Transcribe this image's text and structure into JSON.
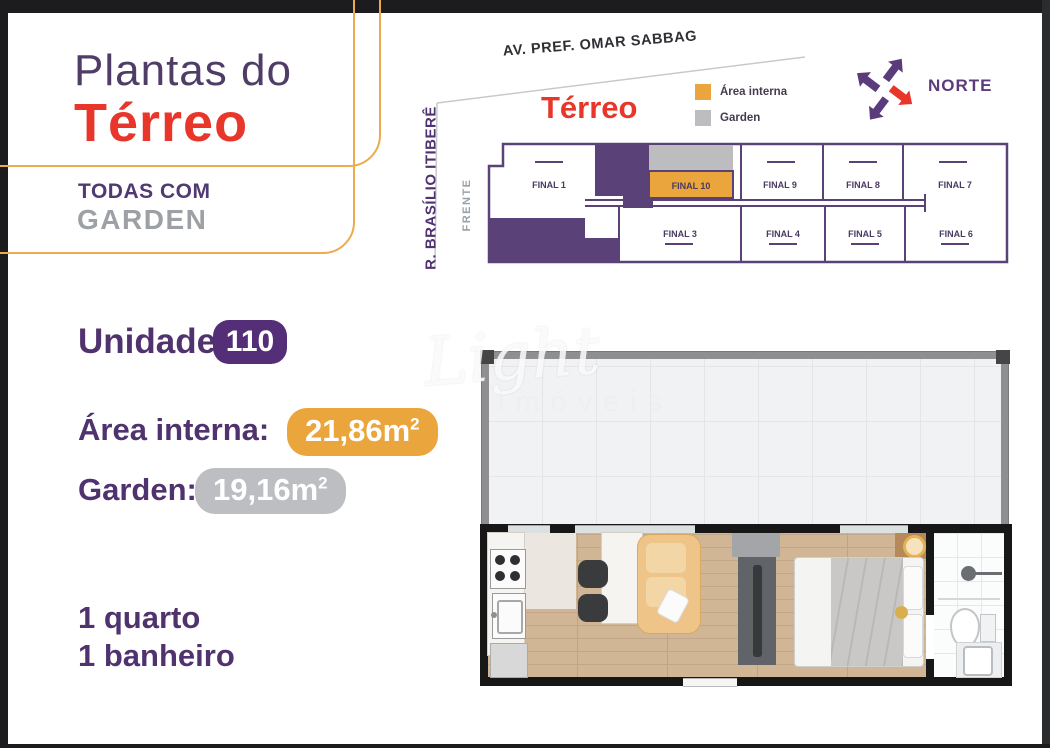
{
  "header_card": {
    "title_line1": "Plantas do",
    "title_line2": "Térreo",
    "subtitle_line1": "TODAS COM",
    "subtitle_line2": "GARDEN"
  },
  "site_plan": {
    "street_top": "AV. PREF. OMAR SABBAG",
    "street_left": "R. BRASÍLIO ITIBERÊ",
    "front_label": "FRENTE",
    "title": "Térreo",
    "legend": [
      {
        "label": "Área interna",
        "color": "#EAA63C"
      },
      {
        "label": "Garden",
        "color": "#BDBDBF"
      }
    ],
    "compass_label": "NORTE",
    "units_top": [
      "FINAL 1",
      "FINAL 10",
      "FINAL 9",
      "FINAL 8",
      "FINAL 7"
    ],
    "units_bottom": [
      "FINAL 3",
      "FINAL 4",
      "FINAL 5",
      "FINAL 6"
    ],
    "highlighted_unit": "FINAL 10"
  },
  "unit_info": {
    "unit_label": "Unidade",
    "unit_number": "110",
    "area_label": "Área interna:",
    "area_value": "21,86m",
    "area_sup": "2",
    "garden_label": "Garden:",
    "garden_value": "19,16m",
    "garden_sup": "2",
    "feature1": "1 quarto",
    "feature2": "1 banheiro"
  },
  "watermark": {
    "line1": "Light",
    "line2": "imóveis"
  },
  "colors": {
    "purple_text": "#50336e",
    "purple_building": "#5a4178",
    "red_accent": "#e8362b",
    "orange_accent": "#eaa63c",
    "gray_accent": "#bdbec1",
    "card_border": "#ecab4e"
  }
}
